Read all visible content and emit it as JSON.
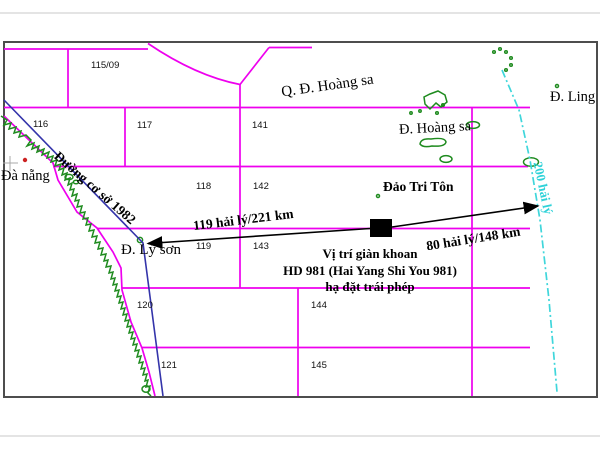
{
  "map": {
    "block_labels": [
      "115/09",
      "116",
      "117",
      "141",
      "118",
      "142",
      "119",
      "143",
      "120",
      "144",
      "121",
      "145"
    ],
    "places": {
      "da_nang": "Đà nẵng",
      "paracel_group": "Q. Đ. Hoàng sa",
      "paracel_island": "Đ. Hoàng sa",
      "ling_island": "Đ. Ling",
      "triton_island": "Đảo Tri Tôn",
      "ly_son": "Đ. Lý sơn"
    },
    "line_labels": {
      "baseline": "Đường cơ sở 1982",
      "eez": "200 hải lý"
    },
    "distances": {
      "west_arrow": "119 hải lý/221 km",
      "east_arrow": "80 hải lý/148 km"
    },
    "rig_annotation": {
      "line1": "Vị trí giàn khoan",
      "line2": "HD 981 (Hai Yang Shi You 981)",
      "line3": "hạ đặt trái phép"
    },
    "colors": {
      "grid": "#ee00ee",
      "baseline": "#3434aa",
      "coast": "#1f8b1f",
      "eez": "#3fd6db",
      "city_marker": "#cc2222",
      "arrow": "#000000"
    }
  }
}
